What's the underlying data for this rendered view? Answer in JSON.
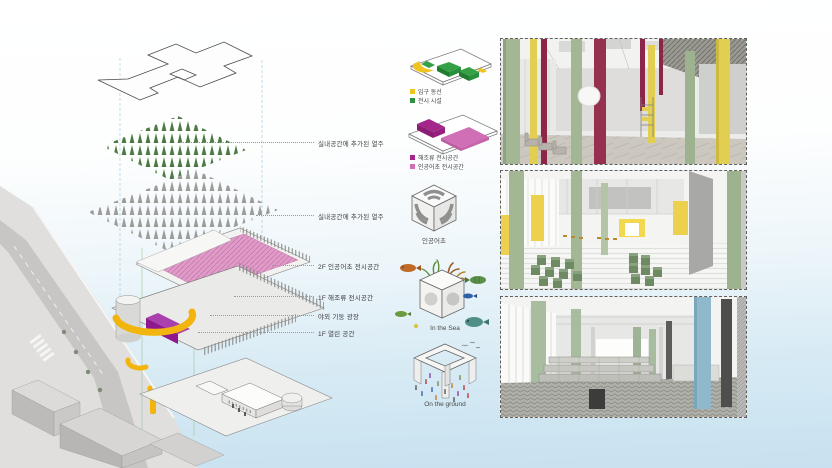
{
  "axon": {
    "labels": [
      "실내공간에 추가된 열주",
      "실내공간에 추가된 열주",
      "2F 인공어초 전시공간",
      "1F 해조류 전시공간",
      "야외 기둥 광장",
      "1F 열린 공간"
    ]
  },
  "mini_diagrams": {
    "circulation": {
      "legend": [
        {
          "color": "#f0c41e",
          "label": "입구 동선"
        },
        {
          "color": "#2e9140",
          "label": "전시 시설"
        }
      ]
    },
    "exhibition": {
      "legend": [
        {
          "color": "#a3278b",
          "label": "해조류 전시공간"
        },
        {
          "color": "#d06fb5",
          "label": "인공어초 전시공간"
        }
      ]
    }
  },
  "cubes": {
    "reef": {
      "caption": "인공어초"
    },
    "sea": {
      "caption": "In the Sea"
    },
    "ground": {
      "caption": "On the ground"
    }
  },
  "colors": {
    "circulation_yellow": "#f0c41e",
    "exhibit_green": "#2e9140",
    "seaweed_magenta": "#a3278b",
    "reef_pink": "#d06fb5",
    "column_green": "#a3b795",
    "column_yellow": "#e2cf52",
    "column_crimson": "#8c2547",
    "column_blue": "#8fb9cb",
    "ribbon_yellow": "#f2b50d",
    "sky_blue": "#c7e1f0"
  }
}
